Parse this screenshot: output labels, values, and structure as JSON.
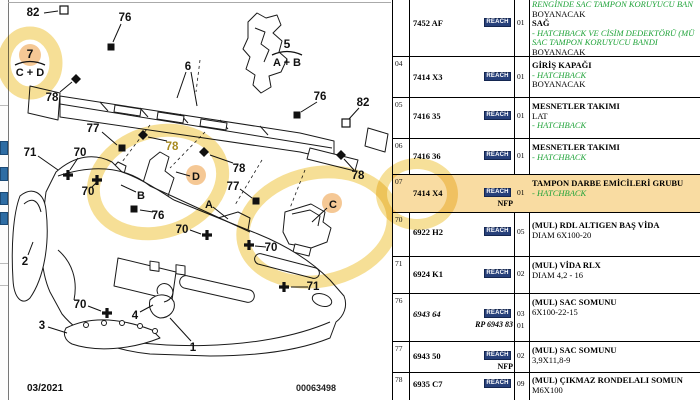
{
  "page": {
    "footer_date": "03/2021",
    "footer_code": "00063498"
  },
  "colors": {
    "highlight": "#F0CC55",
    "row_highlight": "#F9DCA2",
    "badge_bg": "#27407A",
    "green_text": "#1FA339",
    "blue_chip": "#2E6DA4",
    "tinted_label": "#A88A20"
  },
  "diagram": {
    "legends": [
      {
        "num": "7",
        "letters": "C + D",
        "x": 30,
        "y": 54,
        "circled": true
      },
      {
        "num": "5",
        "letters": "A + B",
        "x": 287,
        "y": 44,
        "circled": false
      }
    ],
    "letters": [
      {
        "t": "A",
        "x": 209,
        "y": 204,
        "line": [
          213,
          207,
          228,
          219
        ],
        "circle": false
      },
      {
        "t": "B",
        "x": 141,
        "y": 195,
        "line": [
          136,
          192,
          121,
          185
        ],
        "circle": false
      },
      {
        "t": "C",
        "x": 333,
        "y": 204,
        "line": [
          327,
          208,
          312,
          222
        ],
        "circle": true
      },
      {
        "t": "D",
        "x": 196,
        "y": 176,
        "line": [
          190,
          176,
          176,
          172
        ],
        "circle": true
      }
    ],
    "callouts": [
      {
        "label": "82",
        "lx": 33,
        "ly": 12,
        "marker": "osq",
        "mx": 64,
        "my": 10,
        "line": [
          44,
          13,
          58,
          11
        ]
      },
      {
        "label": "76",
        "lx": 125,
        "ly": 17,
        "marker": "sq",
        "mx": 111,
        "my": 47,
        "line": [
          121,
          24,
          113,
          42
        ]
      },
      {
        "label": "78",
        "lx": 52,
        "ly": 97,
        "marker": "di",
        "mx": 76,
        "my": 79,
        "line": [
          60,
          92,
          72,
          82
        ]
      },
      {
        "label": "6",
        "lx": 188,
        "ly": 66,
        "marker": "none",
        "line": [
          186,
          72,
          177,
          98
        ],
        "line2": [
          191,
          72,
          197,
          106
        ]
      },
      {
        "label": "76",
        "lx": 320,
        "ly": 96,
        "marker": "sq",
        "mx": 297,
        "my": 115,
        "line": [
          317,
          102,
          301,
          112
        ]
      },
      {
        "label": "82",
        "lx": 363,
        "ly": 102,
        "marker": "osq",
        "mx": 346,
        "my": 123,
        "line": [
          359,
          108,
          349,
          119
        ]
      },
      {
        "label": "77",
        "lx": 93,
        "ly": 128,
        "marker": "sq",
        "mx": 122,
        "my": 148,
        "line": [
          102,
          132,
          117,
          145
        ]
      },
      {
        "label": "78",
        "lx": 172,
        "ly": 146,
        "marker": "di",
        "mx": 143,
        "my": 135,
        "line": [
          167,
          141,
          148,
          137
        ],
        "tint": true
      },
      {
        "label": "78",
        "lx": 239,
        "ly": 168,
        "marker": "di",
        "mx": 204,
        "my": 152,
        "line": [
          233,
          163,
          210,
          155
        ]
      },
      {
        "label": "78",
        "lx": 358,
        "ly": 175,
        "marker": "di",
        "mx": 341,
        "my": 155,
        "line": [
          354,
          170,
          344,
          159
        ]
      },
      {
        "label": "71",
        "lx": 30,
        "ly": 152,
        "marker": "none",
        "line": [
          38,
          156,
          58,
          170
        ]
      },
      {
        "label": "70",
        "lx": 80,
        "ly": 152,
        "marker": "cr",
        "mx": 68,
        "my": 175,
        "line": [
          78,
          158,
          70,
          170
        ]
      },
      {
        "label": "70",
        "lx": 88,
        "ly": 191,
        "marker": "cr",
        "mx": 97,
        "my": 180,
        "line": [
          92,
          187,
          96,
          183
        ]
      },
      {
        "label": "76",
        "lx": 158,
        "ly": 215,
        "marker": "sq",
        "mx": 134,
        "my": 209,
        "line": [
          153,
          212,
          140,
          210
        ]
      },
      {
        "label": "70",
        "lx": 182,
        "ly": 229,
        "marker": "cr",
        "mx": 207,
        "my": 235,
        "line": [
          190,
          230,
          201,
          234
        ]
      },
      {
        "label": "77",
        "lx": 233,
        "ly": 186,
        "marker": "sq",
        "mx": 256,
        "my": 201,
        "line": [
          240,
          189,
          252,
          198
        ]
      },
      {
        "label": "70",
        "lx": 271,
        "ly": 247,
        "marker": "cr",
        "mx": 249,
        "my": 245,
        "line": [
          266,
          247,
          255,
          246
        ]
      },
      {
        "label": "70",
        "lx": 80,
        "ly": 304,
        "marker": "cr",
        "mx": 107,
        "my": 313,
        "line": [
          88,
          306,
          101,
          311
        ]
      },
      {
        "label": "71",
        "lx": 313,
        "ly": 286,
        "marker": "cr",
        "mx": 284,
        "my": 287,
        "line": [
          308,
          287,
          291,
          287
        ]
      },
      {
        "label": "1",
        "lx": 193,
        "ly": 347,
        "marker": "none",
        "line": [
          191,
          341,
          170,
          318
        ]
      },
      {
        "label": "2",
        "lx": 25,
        "ly": 261,
        "marker": "none",
        "line": [
          28,
          255,
          33,
          242
        ]
      },
      {
        "label": "3",
        "lx": 42,
        "ly": 325,
        "marker": "none",
        "line": [
          48,
          327,
          67,
          333
        ]
      },
      {
        "label": "4",
        "lx": 135,
        "ly": 315,
        "marker": "none",
        "line": [
          140,
          312,
          153,
          305
        ]
      }
    ]
  },
  "table": {
    "badge_label": "REACH",
    "rows": [
      {
        "index": "",
        "part": "7452 AF",
        "italic": false,
        "rp": "",
        "nfp": "",
        "badge": true,
        "qty": [
          "01"
        ],
        "hl": false,
        "desc": [
          {
            "t": "RENGİNDE SAC TAMPON KORUYUCU BAN",
            "s": "g"
          },
          {
            "t": "BOYANACAK",
            "s": "p"
          },
          {
            "t": "SAĞ",
            "s": "b"
          },
          {
            "t": "- HATCHBACK VE CİSİM DEDEKTÖRÜ (MÜ",
            "s": "g"
          },
          {
            "t": "SAC TAMPON KORUYUCU BANDI",
            "s": "g"
          },
          {
            "t": "BOYANACAK",
            "s": "p"
          }
        ]
      },
      {
        "index": "04",
        "part": "7414 X3",
        "italic": false,
        "rp": "",
        "nfp": "",
        "badge": true,
        "qty": [
          "01"
        ],
        "hl": false,
        "desc": [
          {
            "t": "GİRİŞ KAPAĞI",
            "s": "b"
          },
          {
            "t": "- HATCHBACK",
            "s": "g"
          },
          {
            "t": "BOYANACAK",
            "s": "p"
          }
        ]
      },
      {
        "index": "05",
        "part": "7416 35",
        "italic": false,
        "rp": "",
        "nfp": "",
        "badge": true,
        "qty": [
          "01"
        ],
        "hl": false,
        "desc": [
          {
            "t": "MESNETLER TAKIMI",
            "s": "b"
          },
          {
            "t": "LAT",
            "s": "p"
          },
          {
            "t": "- HATCHBACK",
            "s": "g"
          }
        ]
      },
      {
        "index": "06",
        "part": "7416 36",
        "italic": false,
        "rp": "",
        "nfp": "",
        "badge": true,
        "qty": [
          "01"
        ],
        "hl": false,
        "desc": [
          {
            "t": "MESNETLER TAKIMI",
            "s": "b"
          },
          {
            "t": "- HATCHBACK",
            "s": "g"
          }
        ]
      },
      {
        "index": "07",
        "part": "7414 X4",
        "italic": false,
        "rp": "",
        "nfp": "NFP",
        "badge": true,
        "qty": [
          "01"
        ],
        "hl": true,
        "desc": [
          {
            "t": "TAMPON DARBE EMİCİLERİ GRUBU",
            "s": "b"
          },
          {
            "t": "- HATCHBACK",
            "s": "g"
          }
        ]
      },
      {
        "index": "70",
        "part": "6922 H2",
        "italic": false,
        "rp": "",
        "nfp": "",
        "badge": true,
        "qty": [
          "05"
        ],
        "hl": false,
        "desc": [
          {
            "t": "(MUL) RDL ALTIGEN BAŞ VİDA",
            "s": "b"
          },
          {
            "t": "DIAM 6X100-20",
            "s": "p"
          }
        ]
      },
      {
        "index": "71",
        "part": "6924 K1",
        "italic": false,
        "rp": "",
        "nfp": "",
        "badge": true,
        "qty": [
          "02"
        ],
        "hl": false,
        "desc": [
          {
            "t": "(MUL) VİDA RLX",
            "s": "b"
          },
          {
            "t": "DIAM 4,2 - 16",
            "s": "p"
          }
        ]
      },
      {
        "index": "76",
        "part": "6943 64",
        "italic": true,
        "rp": "RP 6943 83",
        "nfp": "",
        "badge": true,
        "qty": [
          "03",
          "01"
        ],
        "hl": false,
        "desc": [
          {
            "t": "(MUL) SAC SOMUNU",
            "s": "b"
          },
          {
            "t": "6X100-22-15",
            "s": "p"
          }
        ]
      },
      {
        "index": "77",
        "part": "6943 50",
        "italic": false,
        "rp": "",
        "nfp": "NFP",
        "badge": true,
        "qty": [
          "02"
        ],
        "hl": false,
        "desc": [
          {
            "t": "(MUL) SAC SOMUNU",
            "s": "b"
          },
          {
            "t": "3,9X11,8-9",
            "s": "p"
          }
        ]
      },
      {
        "index": "78",
        "part": "6935 C7",
        "italic": false,
        "rp": "",
        "nfp": "",
        "badge": true,
        "qty": [
          "09"
        ],
        "hl": false,
        "desc": [
          {
            "t": "(MUL) ÇIKMAZ RONDELALI SOMUN",
            "s": "b"
          },
          {
            "t": "M6X100",
            "s": "p"
          }
        ]
      }
    ]
  }
}
